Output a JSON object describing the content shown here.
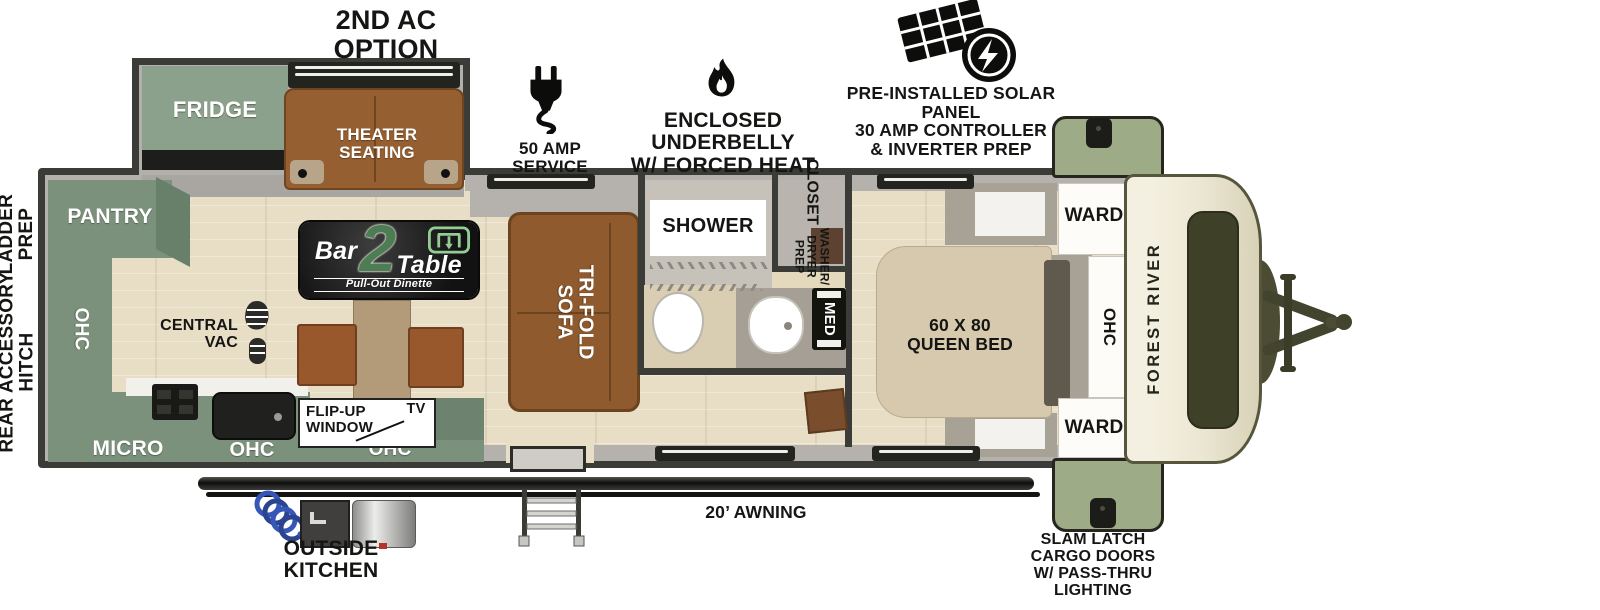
{
  "annotations": {
    "second_ac": "2ND AC\nOPTION",
    "amp_service": "50 AMP SERVICE",
    "underbelly": "ENCLOSED UNDERBELLY\nW/ FORCED HEAT",
    "solar": "PRE-INSTALLED SOLAR PANEL\n30 AMP CONTROLLER\n& INVERTER PREP",
    "ladder_prep": "LADDER\nPREP",
    "rear_hitch": "REAR ACCESSORY\nHITCH",
    "awning": "20’ AWNING",
    "outside_kitchen": "OUTSIDE\nKITCHEN",
    "slam_latch": "SLAM LATCH\nCARGO DOORS\nW/ PASS-THRU\nLIGHTING"
  },
  "rooms": {
    "fridge": "FRIDGE",
    "theater": "THEATER\nSEATING",
    "pantry": "PANTRY",
    "ohc": "OHC",
    "micro": "MICRO",
    "central_vac": "CENTRAL\nVAC",
    "flip_up_window": "FLIP-UP\nWINDOW",
    "tv": "TV",
    "tri_fold": "TRI-FOLD\nSOFA",
    "shower": "SHOWER",
    "closet_title": "CLOSET",
    "closet_sub": "WASHER/\nDRYER\nPREP",
    "med": "MED",
    "queen_bed": "60 X 80\nQUEEN BED",
    "ward": "WARD",
    "brand": "FOREST RIVER"
  },
  "logo": {
    "bar": "Bar",
    "num": "2",
    "table": "Table",
    "sub": "Pull-Out Dinette"
  },
  "colors": {
    "cabinet_green": "#7c917c",
    "cargo_green": "#9dab87",
    "sofa_brown": "#8e5a2e",
    "floor_tan": "#e8dec6",
    "wall_dark": "#3b3b38",
    "cap_cream": "#ece7d3",
    "logo_green": "#4f7d53",
    "hose_blue": "#3757b8"
  }
}
